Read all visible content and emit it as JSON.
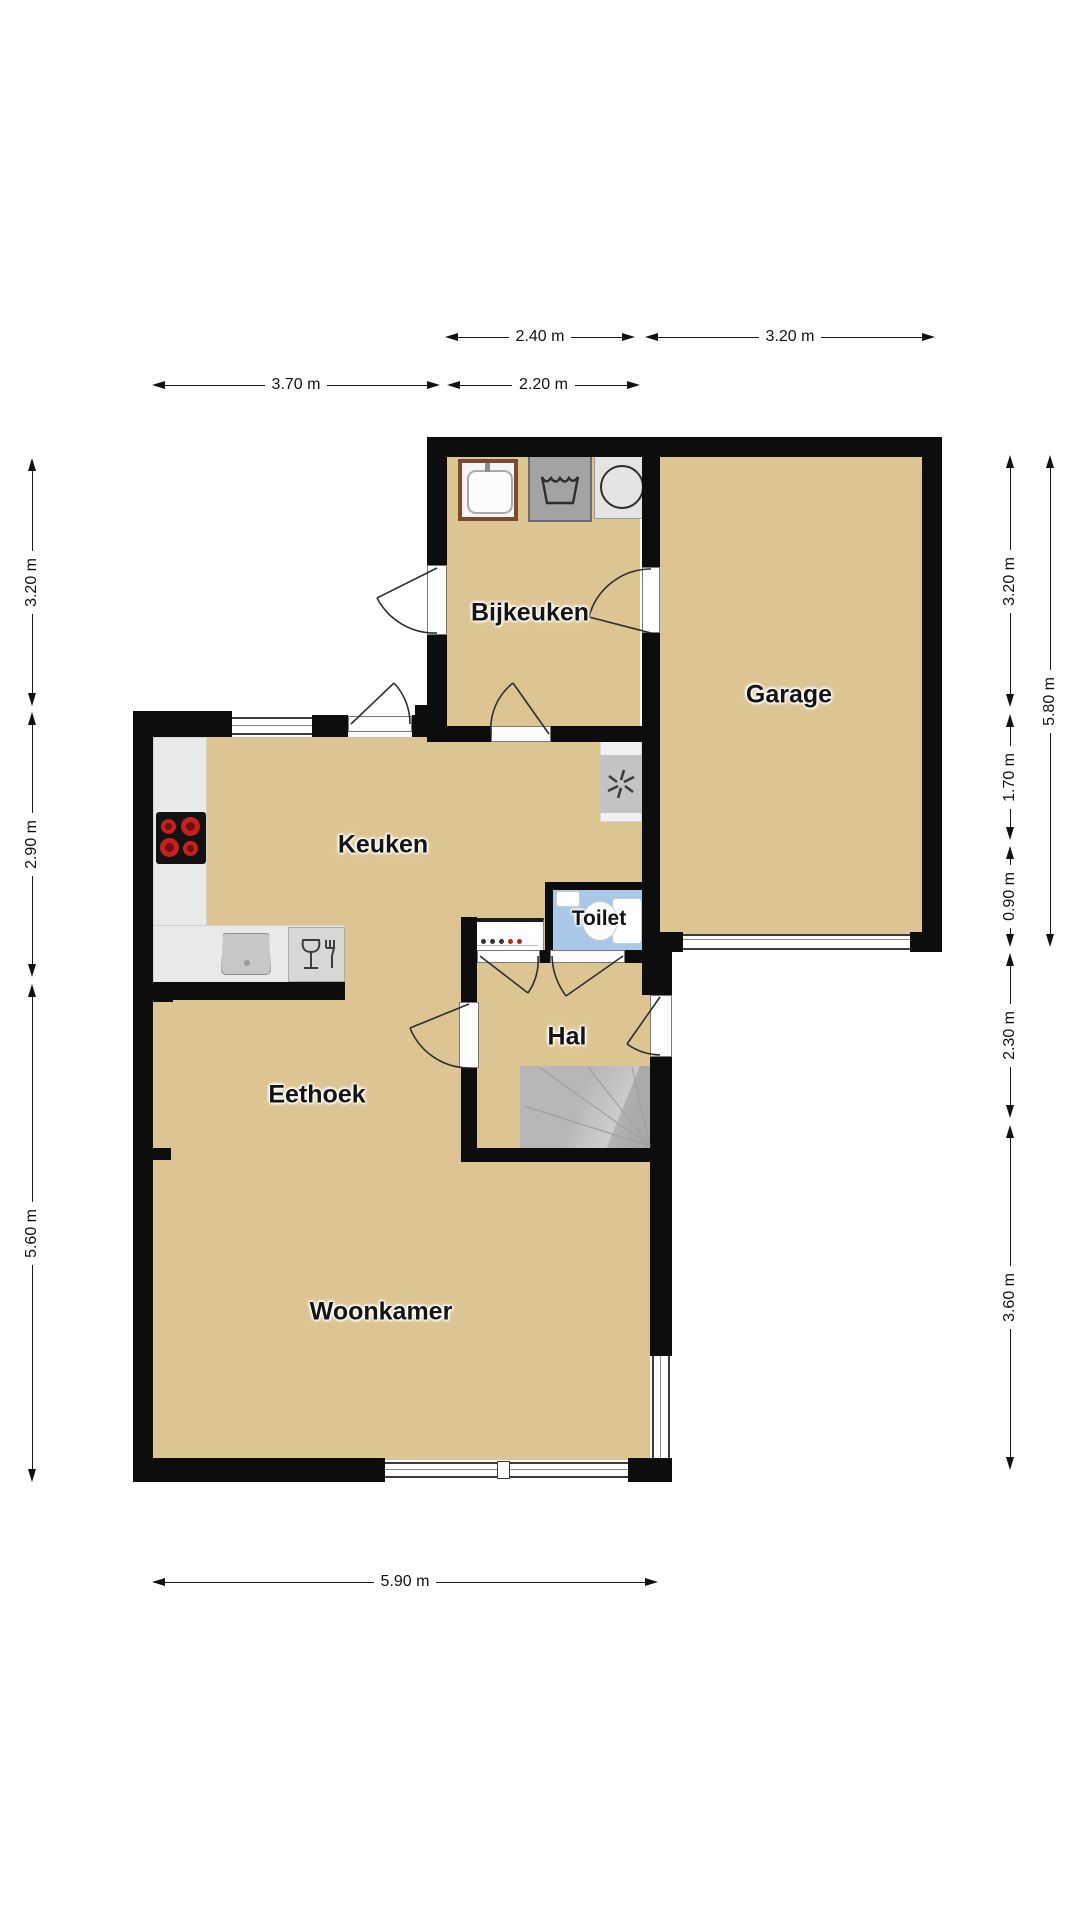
{
  "page": {
    "type": "floor-plan",
    "language": "nl",
    "background": "#ffffff"
  },
  "rooms": [
    {
      "name": "Bijkeuken"
    },
    {
      "name": "Garage"
    },
    {
      "name": "Keuken"
    },
    {
      "name": "Toilet"
    },
    {
      "name": "Hal"
    },
    {
      "name": "Eethoek"
    },
    {
      "name": "Woonkamer"
    }
  ],
  "dimensions": [
    {
      "label": "2.40 m",
      "edge": "top-row-1"
    },
    {
      "label": "3.20 m",
      "edge": "top-row-1"
    },
    {
      "label": "3.70 m",
      "edge": "top-row-2"
    },
    {
      "label": "2.20 m",
      "edge": "top-row-2"
    },
    {
      "label": "3.20 m",
      "edge": "left"
    },
    {
      "label": "2.90 m",
      "edge": "left"
    },
    {
      "label": "5.60 m",
      "edge": "left"
    },
    {
      "label": "3.20 m",
      "edge": "right-inner"
    },
    {
      "label": "1.70 m",
      "edge": "right-inner"
    },
    {
      "label": "0.90 m",
      "edge": "right-inner"
    },
    {
      "label": "2.30 m",
      "edge": "right-inner"
    },
    {
      "label": "3.60 m",
      "edge": "right-inner"
    },
    {
      "label": "5.80 m",
      "edge": "right-outer"
    },
    {
      "label": "5.90 m",
      "edge": "bottom"
    }
  ],
  "icons": {
    "washer": "washing-machine-icon",
    "dryer": "dryer-icon",
    "utility_sink": "utility-sink-icon",
    "stove": "stove-burners-icon",
    "kitchen_sink": "kitchen-sink-icon",
    "dishwasher": "dishwasher-icon",
    "extractor": "extractor-fan-icon",
    "toilet": "toilet-fixture-icon",
    "stairs": "staircase"
  },
  "colors": {
    "floor": "#ddc593",
    "wall": "#0d0d0d",
    "toilet_floor": "#a9c7e6",
    "counter": "#e9e9e9",
    "stairs": "#b7b7b7",
    "burner_red": "#c8211d",
    "dimension_line": "#1a1a1a"
  }
}
